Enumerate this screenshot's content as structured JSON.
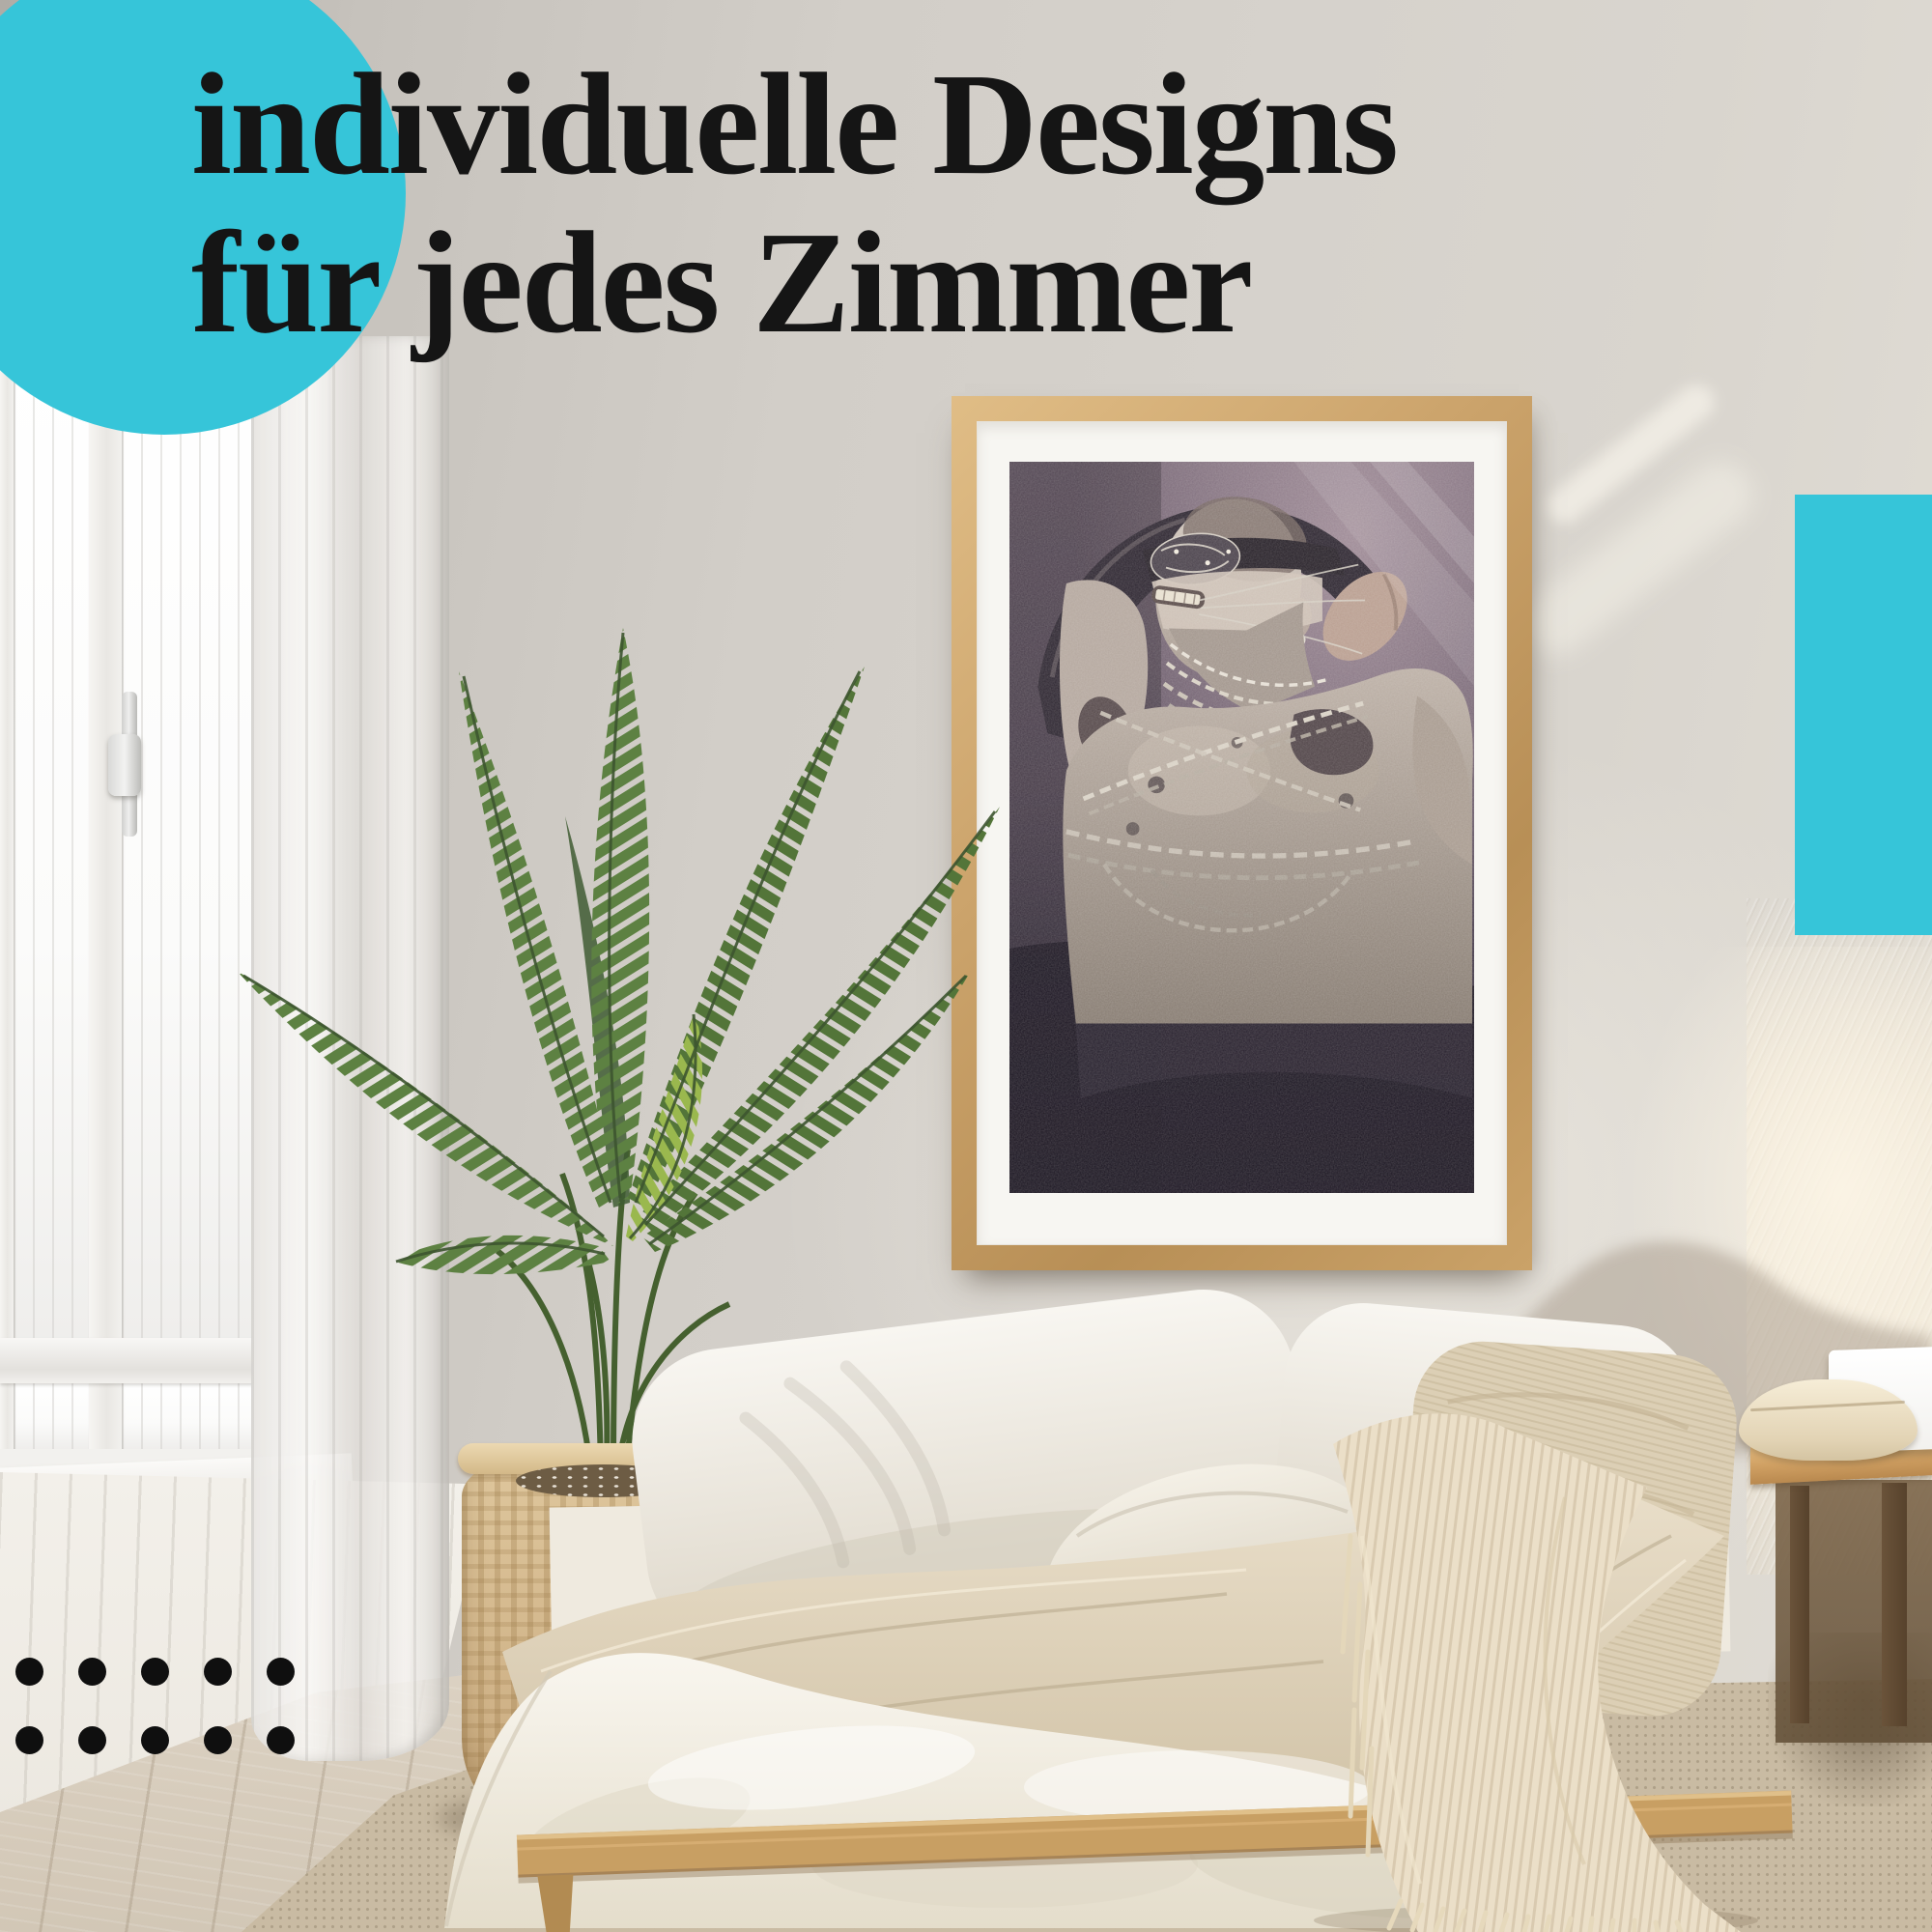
{
  "headline": {
    "line1": "individuelle Designs",
    "line2": "für jedes Zimmer"
  },
  "palette": {
    "accent_cyan": "#36C5D9",
    "headline_text": "#151515",
    "dot_black": "#0F0F0F",
    "frame_wood": "#C9A36B",
    "mat_white": "#F7F6F2",
    "wall_gray": "#D3CFC9",
    "poster_bg_mauve": "#7C6B7A",
    "poster_bg_dark": "#272130",
    "plant_green": "#5D8142",
    "basket_tan": "#D8BF95",
    "bedding_white": "#F6F2EA",
    "blanket_beige": "#DED2BB",
    "throw_cream": "#EADFC8",
    "floor_wood": "#D7CDBF"
  },
  "decor": {
    "dot_grid": {
      "rows": 2,
      "cols": 5
    },
    "accent_circle_position": "top-left",
    "accent_rect_position": "right-edge"
  },
  "poster": {
    "subject": "grayscale figure wrapped in chains on dark purple background"
  }
}
